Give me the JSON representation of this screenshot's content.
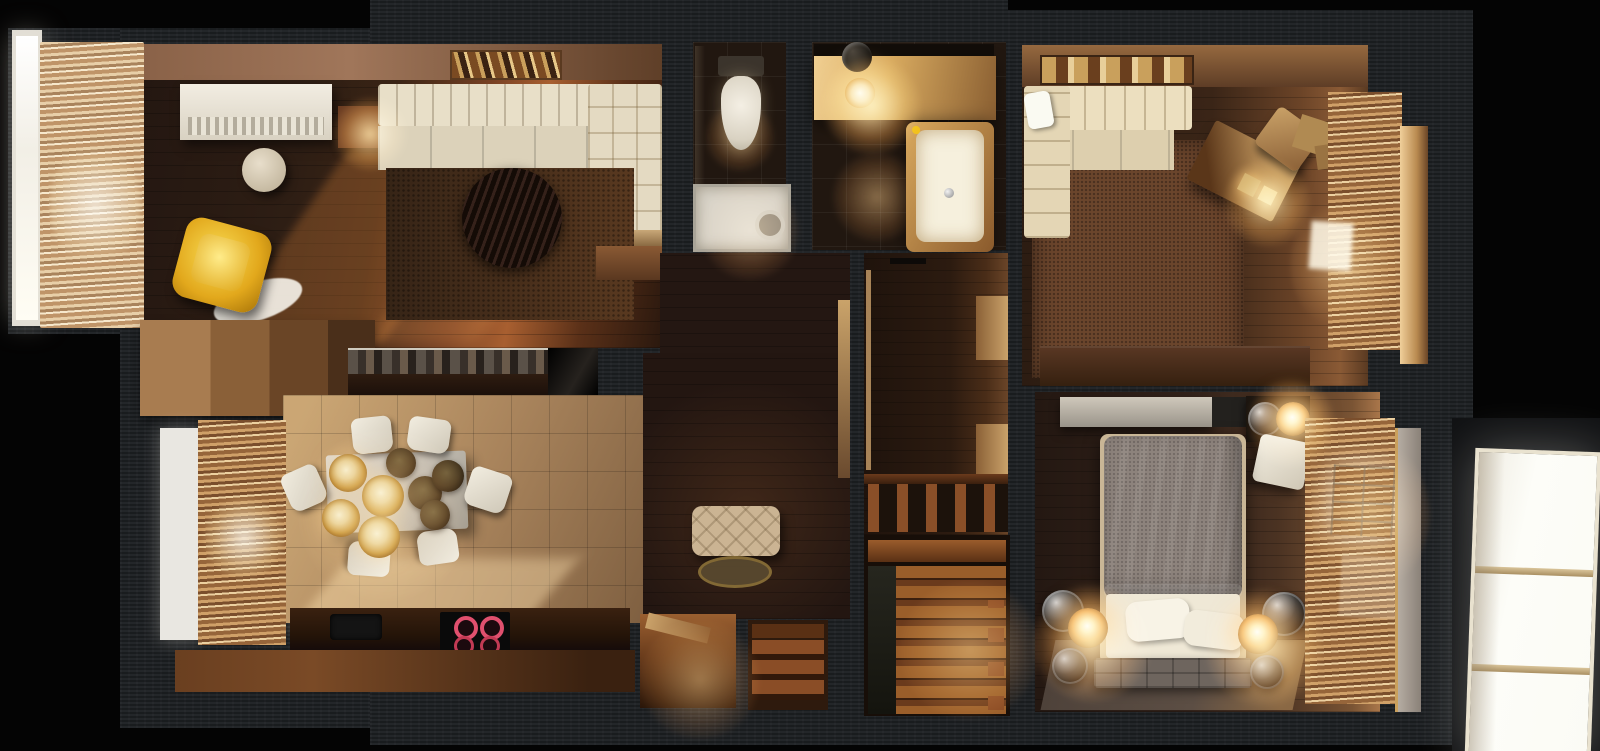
{
  "scene": {
    "kind": "3d-floorplan-render-top-view",
    "description": "Photorealistic top-down 3D render of a dark wood apartment interior at dusk, warm artificial lights and low sun through left windows. No text, labels or UI controls are rendered in the image.",
    "palette": {
      "background": "#040404",
      "wall_charcoal": "#1e2124",
      "wood_floor_dark": "#2e1e14",
      "sunlight_orange": "#c57a3a",
      "kitchen_tile_beige": "#a9845c",
      "cream_upholstery": "#e8dfc8",
      "accent_yellow_chair": "#e2a81c",
      "bath_counter_gold": "#e0bb80",
      "stair_wood_orange": "#9a5e2a",
      "bedroom_duvet_gray": "#8d837b",
      "balcony_window_white": "#fbfbf7",
      "cooktop_burner_red": "#e0506e"
    },
    "rooms": [
      {
        "name": "living-room",
        "items": [
          "left-window",
          "cream-curtains",
          "white-tv-console",
          "candle-side-table",
          "cream-corner-sofa",
          "wall-art",
          "brown-shag-rug",
          "round-dark-coffee-table",
          "yellow-armchair",
          "white-oval-rug",
          "round-side-table",
          "sunbeam"
        ]
      },
      {
        "name": "kitchen-dining",
        "items": [
          "left-window",
          "tan-curtains",
          "tall-cabinets",
          "mosaic-backsplash",
          "black-fridge",
          "dining-table",
          "six-white-chairs",
          "pendant-lamp-cluster-gold",
          "pendant-lamp-cluster-dark",
          "lower-counter",
          "sink",
          "cooktop-red-burners"
        ]
      },
      {
        "name": "wc",
        "items": [
          "toilet",
          "shower-tray",
          "shower-head",
          "glass-wall"
        ]
      },
      {
        "name": "bathroom",
        "items": [
          "mirror-strip",
          "vanity-counter",
          "pendant-sphere-lamp",
          "glowing-bulb",
          "bathtub",
          "rubber-duck",
          "faucet"
        ]
      },
      {
        "name": "hallway",
        "items": [
          "tufted-bench",
          "round-rug",
          "side-door",
          "entry-opening-with-door",
          "entry-opening-with-steps"
        ]
      },
      {
        "name": "wardrobe-corridor",
        "items": [
          "door-edge",
          "wall-cabinets",
          "railing-posts"
        ]
      },
      {
        "name": "staircase",
        "items": [
          "landing",
          "wood-steps",
          "balusters",
          "runner"
        ]
      },
      {
        "name": "office",
        "items": [
          "patterned-rug",
          "cream-corner-sofa",
          "white-pillow",
          "brown-carpet",
          "angled-desk",
          "desk-cube-lamps",
          "tan-chair",
          "storage-boxes",
          "right-curtains",
          "window-light",
          "cream-pelmet",
          "long-sideboard"
        ]
      },
      {
        "name": "bedroom",
        "items": [
          "dresser",
          "nightstand",
          "chrome-globe-lamps",
          "lit-globe-lamps",
          "white-armchair",
          "double-bed",
          "gray-duvet",
          "white-sheet",
          "two-pillows",
          "foot-bench",
          "gray-rug",
          "right-curtains",
          "window-light",
          "cream-pelmet"
        ]
      },
      {
        "name": "balcony",
        "items": [
          "bright-paned-window"
        ]
      }
    ]
  }
}
